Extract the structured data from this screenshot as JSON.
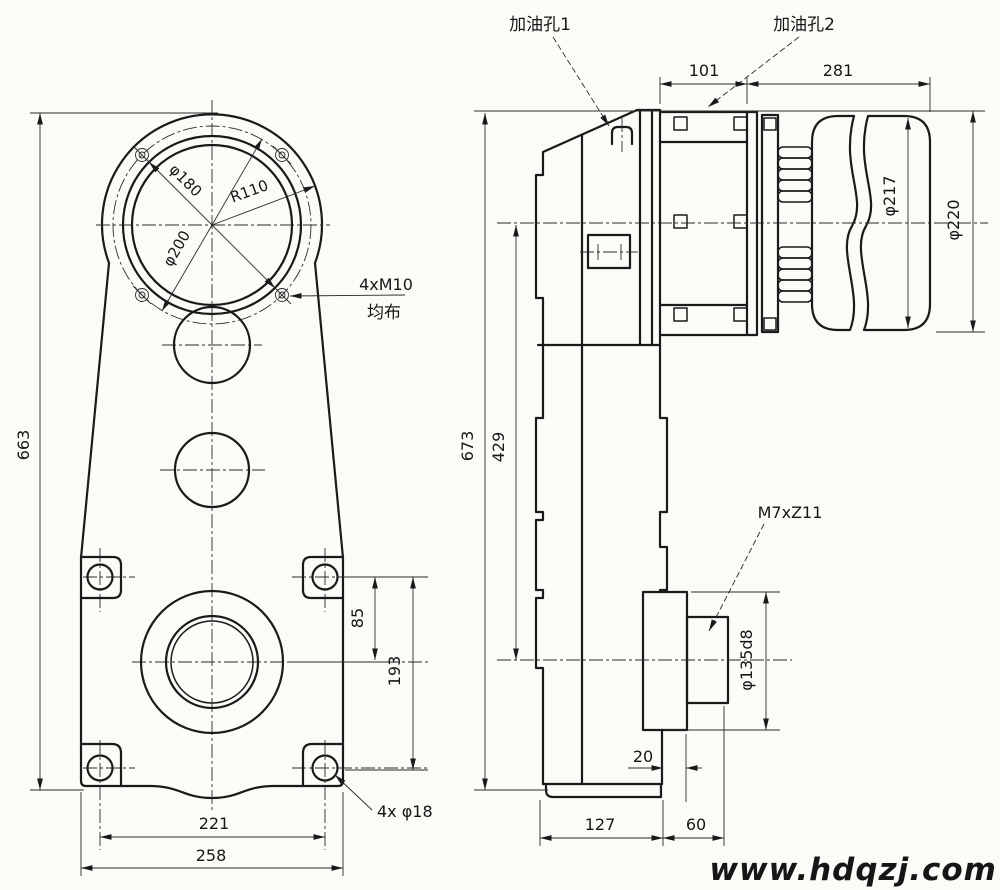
{
  "watermark": {
    "text": "www.hdqzj.com",
    "color": "#1b22dd"
  },
  "callouts": {
    "oil_hole_1": "加油孔1",
    "oil_hole_2": "加油孔2",
    "bolt_pattern": "4xM10",
    "bolt_pattern_note": "均布",
    "base_holes": "4x φ18",
    "spline": "M7xZ11"
  },
  "front_view": {
    "height": "663",
    "bore_dia": "φ180",
    "housing_radius": "R110",
    "bolt_circle_dia": "φ200",
    "hole_offset": "85",
    "axis_offset": "193",
    "hole_span": "221",
    "base_width": "258"
  },
  "side_view": {
    "height": "673",
    "axis_distance": "429",
    "adapter_length": "101",
    "motor_length": "281",
    "motor_dia": "φ217",
    "motor_od": "φ220",
    "hub_dia": "φ135d8",
    "hub_overhang": "20",
    "base_length": "127",
    "shaft_overhang": "60"
  }
}
